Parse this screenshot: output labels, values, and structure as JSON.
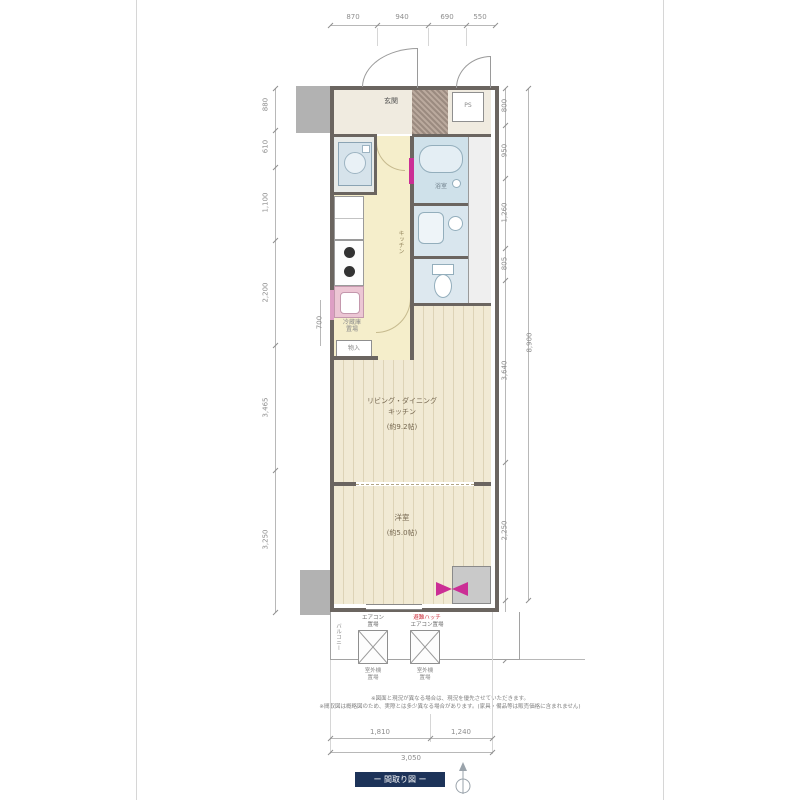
{
  "colors": {
    "accent": "#cb2e95",
    "wall": "#6b6560",
    "badge_bg": "#1d3359",
    "bath_fill": "#cfe1ea",
    "corridor_fill": "#f5eecb"
  },
  "dims": {
    "top": [
      "870",
      "940",
      "690",
      "550"
    ],
    "left": [
      "880",
      "610",
      "1,100",
      "2,200",
      "3,465",
      "3,250"
    ],
    "left_small": "700",
    "right": [
      "800",
      "950",
      "1,260",
      "805",
      "3,640",
      "2,250"
    ],
    "right_total": "8,900",
    "right_balcony": "1,460",
    "bottom": [
      "1,810",
      "1,240"
    ],
    "bottom_total": "3,050"
  },
  "rooms": {
    "entrance": "玄関",
    "bath": "浴室",
    "kitchen": "キッチン",
    "fridge_l1": "冷蔵庫",
    "fridge_l2": "置場",
    "storage": "物入",
    "ps": "PS",
    "ldk_l1": "リビング・ダイニング",
    "ldk_l2": "キッチン",
    "ldk_area": "(約9.2帖)",
    "bedroom": "洋室",
    "bedroom_area": "(約5.0帖)",
    "balcony": "バルコニー"
  },
  "balcony_units": {
    "u1_top_l1": "エアコン",
    "u1_top_l2": "置場",
    "u1_bot_l1": "室外機",
    "u1_bot_l2": "置場",
    "u2_top_l1": "避難ハッチ",
    "u2_top_l2": "エアコン置場",
    "u2_bot_l1": "室外機",
    "u2_bot_l2": "置場"
  },
  "footer": {
    "note1": "※図面と現況が異なる場合は、現況を優先させていただきます。",
    "note2": "※間取図は概略図のため、実際とは多少異なる場合があります。(家具・備品等は販売価格に含まれません)",
    "badge": "ー 間取り図 ー"
  }
}
